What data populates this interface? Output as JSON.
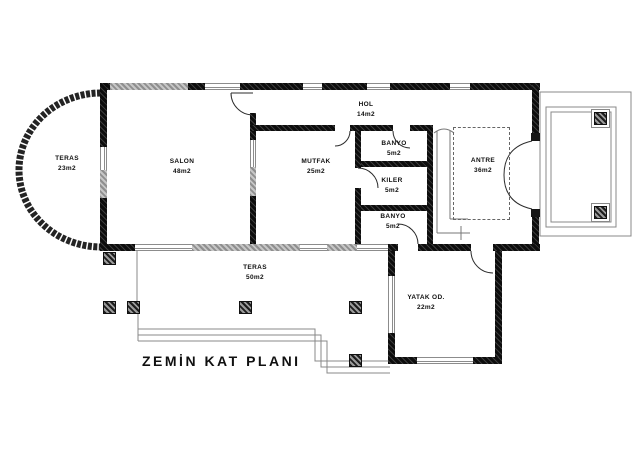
{
  "title": "ZEMİN KAT PLANI",
  "drawing": {
    "type": "architectural-floor-plan",
    "background_color": "#ffffff",
    "wall_color": "#161616",
    "window_color": "#8c8c8c",
    "thin_line_color": "#888888",
    "text_color": "#101010"
  },
  "rooms": [
    {
      "id": "teras-sol",
      "name": "TERAS",
      "area": "23m2"
    },
    {
      "id": "salon",
      "name": "SALON",
      "area": "48m2"
    },
    {
      "id": "mutfak",
      "name": "MUTFAK",
      "area": "25m2"
    },
    {
      "id": "hol",
      "name": "HOL",
      "area": "14m2"
    },
    {
      "id": "banyo-ust",
      "name": "BANYO",
      "area": "5m2"
    },
    {
      "id": "kiler",
      "name": "KILER",
      "area": "5m2"
    },
    {
      "id": "banyo-alt",
      "name": "BANYO",
      "area": "5m2"
    },
    {
      "id": "antre",
      "name": "ANTRE",
      "area": "36m2"
    },
    {
      "id": "teras-alt",
      "name": "TERAS",
      "area": "50m2"
    },
    {
      "id": "yatak-odasi",
      "name": "YATAK OD.",
      "area": "22m2"
    }
  ]
}
